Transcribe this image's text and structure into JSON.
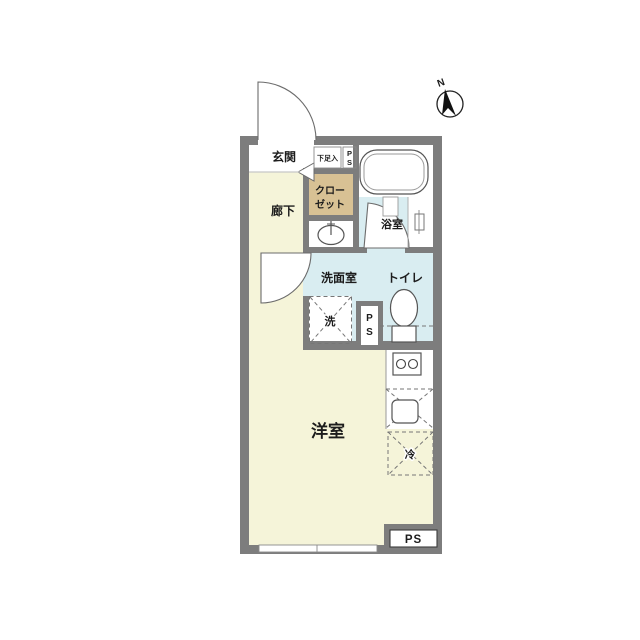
{
  "colors": {
    "wall": "#7d7d7d",
    "room_floor": "#f5f4d9",
    "wet_floor": "#d9edf1",
    "closet_fill": "#d8c194",
    "white": "#ffffff"
  },
  "labels": {
    "entrance": "玄関",
    "shoe_storage": "下足入",
    "ps_top": {
      "p": "P",
      "s": "S"
    },
    "closet": {
      "line1": "クロー",
      "line2": "ゼット"
    },
    "hallway": "廊下",
    "bathroom": "浴室",
    "washroom": "洗面室",
    "toilet": "トイレ",
    "washer": "洗",
    "ps_mid": {
      "p": "P",
      "s": "S"
    },
    "western_room": "洋室",
    "refrigerator": "冷",
    "ps_bottom": "PS",
    "compass_north": "N"
  }
}
